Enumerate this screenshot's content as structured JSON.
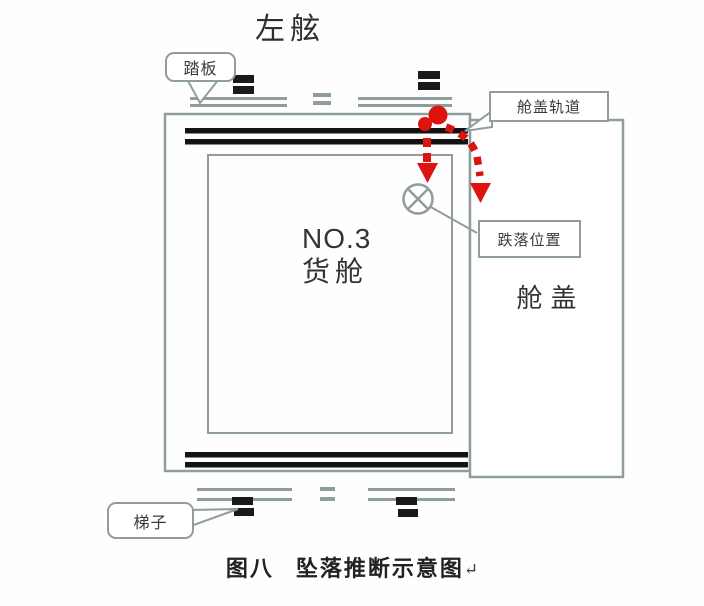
{
  "figure": {
    "title_top": "左舷",
    "cargo_hold": {
      "line1": "NO.3",
      "line2": "货舱"
    },
    "hatch_cover": "舱盖",
    "callouts": {
      "tread_plate": "踏板",
      "hatch_rail": "舱盖轨道",
      "fall_position": "跌落位置",
      "ladder": "梯子"
    },
    "caption": {
      "figure_no": "图八",
      "text": "坠落推断示意图",
      "return_mark": "↵"
    }
  },
  "colors": {
    "outline_gray": "#8f9e9c",
    "rail_black": "#131313",
    "trajectory_red": "#dc1410",
    "text": "#2c2c2c",
    "background": "#fefefe"
  }
}
